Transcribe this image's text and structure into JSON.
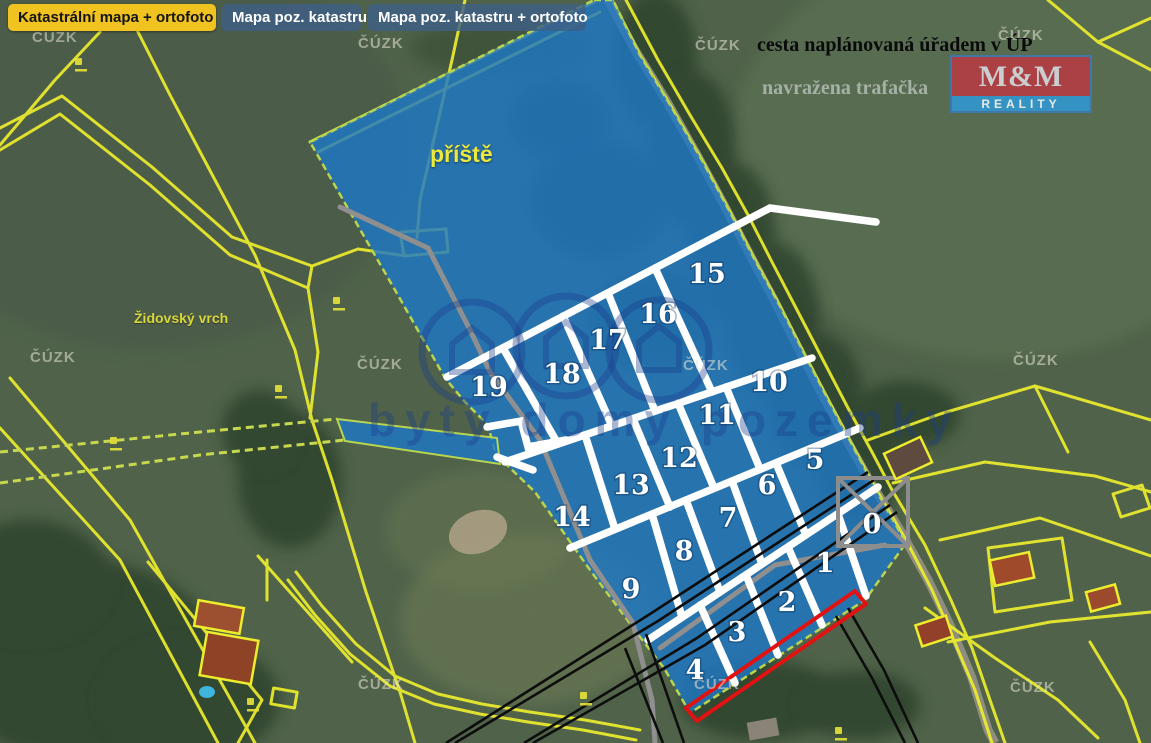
{
  "header": {
    "tabs": [
      {
        "label": "Katastrální mapa + ortofoto",
        "active": true
      },
      {
        "label": "Mapa poz. katastru",
        "active": false
      },
      {
        "label": "Mapa poz. katastru + ortofoto",
        "active": false
      }
    ]
  },
  "notes": {
    "planned_road": "cesta naplánovaná úřadem v ÚP",
    "transformer": "navražena trafačka"
  },
  "map_labels": {
    "future_area": "příště",
    "hill": "Židovský vrch"
  },
  "logo": {
    "top": "M&M",
    "bottom": "REALITY"
  },
  "watermarks": {
    "agency": "ČÚZK",
    "agency_positions": [
      [
        32,
        30
      ],
      [
        358,
        36
      ],
      [
        695,
        38
      ],
      [
        998,
        28
      ],
      [
        30,
        350
      ],
      [
        357,
        357
      ],
      [
        683,
        358
      ],
      [
        1013,
        353
      ],
      [
        358,
        677
      ],
      [
        694,
        677
      ],
      [
        1010,
        680
      ]
    ],
    "portal": "byty domy pozemky"
  },
  "plots": [
    {
      "n": "0",
      "x": 872,
      "y": 524
    },
    {
      "n": "1",
      "x": 825,
      "y": 563
    },
    {
      "n": "2",
      "x": 787,
      "y": 602
    },
    {
      "n": "3",
      "x": 737,
      "y": 632
    },
    {
      "n": "4",
      "x": 695,
      "y": 670
    },
    {
      "n": "5",
      "x": 815,
      "y": 460
    },
    {
      "n": "6",
      "x": 767,
      "y": 485
    },
    {
      "n": "7",
      "x": 728,
      "y": 518
    },
    {
      "n": "8",
      "x": 684,
      "y": 551
    },
    {
      "n": "9",
      "x": 631,
      "y": 589
    },
    {
      "n": "10",
      "x": 769,
      "y": 382
    },
    {
      "n": "11",
      "x": 717,
      "y": 415
    },
    {
      "n": "12",
      "x": 679,
      "y": 458
    },
    {
      "n": "13",
      "x": 631,
      "y": 485
    },
    {
      "n": "14",
      "x": 572,
      "y": 517
    },
    {
      "n": "15",
      "x": 707,
      "y": 274
    },
    {
      "n": "16",
      "x": 658,
      "y": 314
    },
    {
      "n": "17",
      "x": 608,
      "y": 340
    },
    {
      "n": "18",
      "x": 562,
      "y": 374
    },
    {
      "n": "19",
      "x": 489,
      "y": 387
    }
  ],
  "colors": {
    "tab_active_bg": "#f0c320",
    "tab_inactive_bg": "#3e5f85",
    "parcel_line_yellow": "#eded2e",
    "plot_fill_blue": "#1f78c4",
    "divider_white": "#ffffff",
    "planned_road_black": "#0d0d0d",
    "highlight_strip_red": "#e01212",
    "existing_path_gray": "#8f8f8f",
    "logo_red": "#bb3a44",
    "logo_blue": "#2e9bd6",
    "label_yellow": "#ece93c"
  }
}
